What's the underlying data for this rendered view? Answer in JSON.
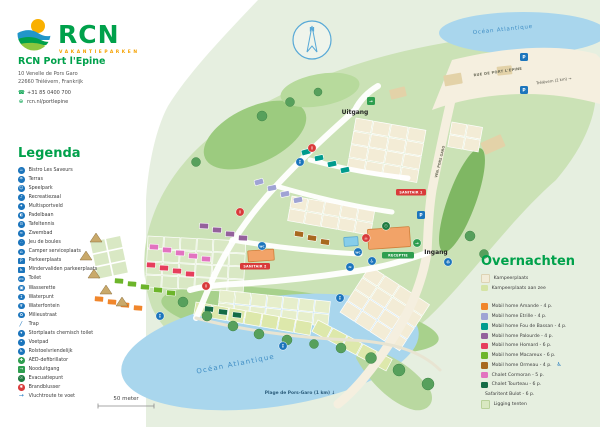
{
  "brand": {
    "logo_text": "RCN",
    "tagline": "VAKANTIEPARKEN"
  },
  "park": {
    "name": "RCN Port l'Epine",
    "address_line1": "10 Venelle de Pors Garo",
    "address_line2": "22660 Trélévern, Frankrijk",
    "phone": "+31 85 0400 700",
    "website": "rcn.nl/portlepine"
  },
  "legend": {
    "heading": "Legenda",
    "default_icon_bg": "#1c75bc",
    "items": [
      {
        "icon": "restaurant-icon",
        "glyph": "☕",
        "label": "Bistro Les Saveurs"
      },
      {
        "icon": "terrace-icon",
        "glyph": "☂",
        "label": "Terras"
      },
      {
        "icon": "playground-icon",
        "glyph": "☺",
        "label": "Speelpark"
      },
      {
        "icon": "recreation-hall-icon",
        "glyph": "♪",
        "label": "Recreatiezaal"
      },
      {
        "icon": "multisport-icon",
        "glyph": "✦",
        "label": "Multisportveld"
      },
      {
        "icon": "padel-icon",
        "glyph": "◐",
        "label": "Padelbaan"
      },
      {
        "icon": "table-tennis-icon",
        "glyph": "⊙",
        "label": "Tafeltennis"
      },
      {
        "icon": "pool-icon",
        "glyph": "≈",
        "label": "Zwembad"
      },
      {
        "icon": "petanque-icon",
        "glyph": "∴",
        "label": "Jeu de boules"
      },
      {
        "icon": "camper-service-icon",
        "glyph": "⌂",
        "label": "Camper serviceplaats"
      },
      {
        "icon": "parking-icon",
        "glyph": "P",
        "shape": "square",
        "label": "Parkeerplaats"
      },
      {
        "icon": "disabled-parking-icon",
        "glyph": "♿",
        "shape": "square",
        "label": "Mindervaliden parkeerplaats"
      },
      {
        "icon": "toilet-icon",
        "glyph": "WC",
        "label": "Toilet"
      },
      {
        "icon": "laundry-icon",
        "glyph": "▣",
        "label": "Wasserette"
      },
      {
        "icon": "water-tap-icon",
        "glyph": "↧",
        "label": "Waterpunt"
      },
      {
        "icon": "fountain-icon",
        "glyph": "♆",
        "label": "Waterfontein"
      },
      {
        "icon": "recycling-icon",
        "glyph": "♻",
        "label": "Milieustraat"
      },
      {
        "icon": "stairs-icon",
        "glyph": "╱",
        "shape": "bare",
        "label": "Trap"
      },
      {
        "icon": "chemical-toilet-icon",
        "glyph": "▾",
        "label": "Stortplaats chemisch toilet"
      },
      {
        "icon": "footpath-icon",
        "glyph": "•",
        "label": "Voetpad"
      },
      {
        "icon": "wheelchair-icon",
        "glyph": "♿",
        "label": "Rolstoelvriendelijk"
      },
      {
        "icon": "aed-icon",
        "glyph": "✚",
        "bg": "#2e9e4f",
        "label": "AED-defibrillator"
      },
      {
        "icon": "emergency-exit-icon",
        "glyph": "→",
        "shape": "square",
        "bg": "#2e9e4f",
        "label": "Nooduitgang"
      },
      {
        "icon": "evacuation-icon",
        "glyph": "☉",
        "bg": "#1d7a3f",
        "label": "Evacuatiepunt"
      },
      {
        "icon": "fire-extinguisher-icon",
        "glyph": "✱",
        "bg": "#d93a3a",
        "label": "Brandblusser"
      },
      {
        "icon": "escape-route-icon",
        "glyph": "→",
        "shape": "bare",
        "label": "Vluchtroute te voet"
      }
    ]
  },
  "accommodations": {
    "heading": "Overnachten",
    "colors": {
      "kampeerplaats": "#f2ecd8",
      "aanzee": "#d5e4a5",
      "amande": "#f0862c",
      "etrille": "#9fa3d4",
      "fou": "#009b8d",
      "palourde": "#94619c",
      "homard": "#e63e5c",
      "macareux": "#6db52b",
      "ormeau": "#a8681f",
      "cormoran": "#e273c0",
      "tourteau": "#156b46",
      "bulot": "#c9a96a",
      "ligging": "#d9e8c2"
    },
    "items": [
      {
        "label": "Kampeerplaats",
        "key": "kampeerplaats",
        "border": "#ddd3b4"
      },
      {
        "label": "Kampeerplaats aan zee",
        "key": "aanzee",
        "gap": true
      },
      {
        "label": "Mobil home Amande - 4 p.",
        "key": "amande"
      },
      {
        "label": "Mobil home Etrille - 4 p.",
        "key": "etrille"
      },
      {
        "label": "Mobil home Fou de Bassan - 4 p.",
        "key": "fou"
      },
      {
        "label": "Mobil home Palourde - 4 p.",
        "key": "palourde"
      },
      {
        "label": "Mobil home Homard - 6 p.",
        "key": "homard"
      },
      {
        "label": "Mobil home Macareux - 6 p.",
        "key": "macareux"
      },
      {
        "label": "Mobil home Ormeau - 4 p.",
        "key": "ormeau",
        "wheelchair": true
      },
      {
        "label": "Chalet Cormoran - 5 p.",
        "key": "cormoran"
      },
      {
        "label": "Chalet Tourteau - 6 p.",
        "key": "tourteau"
      },
      {
        "label": "Safaritent Bulot - 6 p.",
        "key": "bulot",
        "tent": true
      },
      {
        "label": "Ligging tenten",
        "key": "ligging",
        "border": "#b9d19a"
      }
    ]
  },
  "map": {
    "compass_n": "N",
    "labels": [
      {
        "id": "ocean-top",
        "text": "Océan Atlantique",
        "x": 503,
        "y": 31,
        "size": 5.5,
        "fill": "#3f8dc4",
        "rot": -6,
        "ls": 0.8
      },
      {
        "id": "ocean-bottom",
        "text": "Océan Atlantique",
        "x": 236,
        "y": 366,
        "size": 7,
        "fill": "#3f8dc4",
        "rot": -11,
        "ls": 1.2
      },
      {
        "id": "road-rue",
        "text": "RUE DE PORT L'ÉPINE",
        "x": 498,
        "y": 73,
        "size": 3.6,
        "fill": "#6a6a58",
        "rot": -8,
        "ls": 0.3,
        "bold": true
      },
      {
        "id": "road-trelevern",
        "text": "Trélévern (2 km) →",
        "x": 554,
        "y": 82,
        "size": 3.8,
        "fill": "#55544a",
        "rot": -8
      },
      {
        "id": "road-ven",
        "text": "VEN. PORS GARO",
        "x": 441,
        "y": 162,
        "size": 3.4,
        "fill": "#6a6a58",
        "rot": -76,
        "bold": true
      },
      {
        "id": "exit-label",
        "text": "Uitgang",
        "x": 355,
        "y": 114,
        "size": 6,
        "fill": "#222",
        "bold": true
      },
      {
        "id": "entrance-label",
        "text": "Ingang",
        "x": 436,
        "y": 254,
        "size": 6,
        "fill": "#222",
        "bold": true
      },
      {
        "id": "beach-label",
        "text": "Plage de Pors-Garo (1 km) ↓",
        "x": 300,
        "y": 394,
        "size": 4.4,
        "fill": "#2c5d7c",
        "bold": true
      },
      {
        "id": "scale-label",
        "text": "50 meter",
        "x": 126,
        "y": 400,
        "size": 5.5,
        "fill": "#444"
      }
    ],
    "badges": [
      {
        "text": "RECEPTIE",
        "x": 382,
        "y": 252,
        "w": 32,
        "bg": "#2e9e4f"
      },
      {
        "text": "SANITAIR 1",
        "x": 396,
        "y": 189,
        "w": 30,
        "bg": "#d93a3a"
      },
      {
        "text": "SANITAIR 2",
        "x": 240,
        "y": 263,
        "w": 30,
        "bg": "#d93a3a"
      }
    ],
    "icons": [
      {
        "name": "parking-icon",
        "x": 524,
        "y": 57,
        "shape": "square",
        "bg": "#1c75bc",
        "glyph": "P"
      },
      {
        "name": "parking-icon",
        "x": 524,
        "y": 90,
        "shape": "square",
        "bg": "#1c75bc",
        "glyph": "P"
      },
      {
        "name": "parking-icon",
        "x": 421,
        "y": 215,
        "shape": "square",
        "bg": "#1c75bc",
        "glyph": "P"
      },
      {
        "name": "exit-icon",
        "x": 371,
        "y": 101,
        "shape": "square",
        "bg": "#2e9e4f",
        "glyph": "→"
      },
      {
        "name": "entrance-icon",
        "x": 417,
        "y": 243,
        "shape": "circle",
        "bg": "#2e9e4f",
        "glyph": "→"
      },
      {
        "name": "info-icon",
        "x": 312,
        "y": 148,
        "shape": "circle",
        "bg": "#d93a3a",
        "glyph": "i"
      },
      {
        "name": "info-icon",
        "x": 240,
        "y": 212,
        "shape": "circle",
        "bg": "#d93a3a",
        "glyph": "i"
      },
      {
        "name": "info-icon",
        "x": 206,
        "y": 286,
        "shape": "circle",
        "bg": "#d93a3a",
        "glyph": "i"
      },
      {
        "name": "restaurant-icon",
        "x": 366,
        "y": 238,
        "shape": "circle",
        "bg": "#d93a3a",
        "glyph": "☕"
      },
      {
        "name": "toilet-icon",
        "x": 358,
        "y": 252,
        "shape": "circle",
        "bg": "#1c75bc",
        "glyph": "WC"
      },
      {
        "name": "wheelchair-icon",
        "x": 372,
        "y": 261,
        "shape": "circle",
        "bg": "#1c75bc",
        "glyph": "♿"
      },
      {
        "name": "pool-icon",
        "x": 350,
        "y": 267,
        "shape": "circle",
        "bg": "#1c75bc",
        "glyph": "≈"
      },
      {
        "name": "evacuation-icon",
        "x": 386,
        "y": 226,
        "shape": "circle",
        "bg": "#1d7a3f",
        "glyph": "☉"
      },
      {
        "name": "water-tap-icon",
        "x": 300,
        "y": 162,
        "shape": "circle",
        "bg": "#1c75bc",
        "glyph": "↧"
      },
      {
        "name": "water-tap-icon",
        "x": 340,
        "y": 298,
        "shape": "circle",
        "bg": "#1c75bc",
        "glyph": "↧"
      },
      {
        "name": "toilet-icon",
        "x": 262,
        "y": 246,
        "shape": "circle",
        "bg": "#1c75bc",
        "glyph": "WC"
      },
      {
        "name": "water-tap-icon",
        "x": 160,
        "y": 316,
        "shape": "circle",
        "bg": "#1c75bc",
        "glyph": "↧"
      },
      {
        "name": "water-tap-icon",
        "x": 283,
        "y": 346,
        "shape": "circle",
        "bg": "#1c75bc",
        "glyph": "↧"
      },
      {
        "name": "recycling-icon",
        "x": 448,
        "y": 262,
        "shape": "circle",
        "bg": "#1c75bc",
        "glyph": "♻"
      }
    ],
    "clusters": [
      {
        "x": 356,
        "y": 118,
        "rows": 4,
        "cols": 4,
        "cw": 17,
        "ch": 12.5,
        "angle": 10,
        "fill": "#f3ecd6"
      },
      {
        "x": 452,
        "y": 122,
        "rows": 2,
        "cols": 2,
        "cw": 15,
        "ch": 12,
        "angle": 10,
        "fill": "#f3ecd6"
      },
      {
        "x": 292,
        "y": 196,
        "rows": 2,
        "cols": 5,
        "cw": 16,
        "ch": 12,
        "angle": 10,
        "fill": "#f3ecd6"
      },
      {
        "x": 370,
        "y": 266,
        "rows": 4,
        "cols": 4,
        "cw": 17,
        "ch": 13,
        "angle": 33,
        "fill": "#f3ecd6"
      },
      {
        "x": 148,
        "y": 236,
        "rows": 4,
        "cols": 6,
        "cw": 15.5,
        "ch": 12,
        "angle": 3,
        "fill": "#d9e8c4"
      },
      {
        "x": 220,
        "y": 290,
        "rows": 2,
        "cols": 7,
        "cw": 15,
        "ch": 12,
        "angle": 6,
        "fill": "#e6eecb"
      },
      {
        "x": 196,
        "y": 302,
        "rows": 1,
        "cols": 7,
        "cw": 16,
        "ch": 13,
        "angle": 10,
        "fill": "#dde8ab"
      },
      {
        "x": 318,
        "y": 320,
        "rows": 1,
        "cols": 5,
        "cw": 16,
        "ch": 13,
        "angle": 28,
        "fill": "#dde8ab"
      },
      {
        "x": 90,
        "y": 242,
        "rows": 3,
        "cols": 2,
        "cw": 15,
        "ch": 12,
        "angle": -12,
        "fill": "#d9e8c4"
      }
    ],
    "homes": [
      {
        "x": 306,
        "y": 152,
        "a": -15,
        "key": "fou"
      },
      {
        "x": 319,
        "y": 158,
        "a": -12,
        "key": "fou"
      },
      {
        "x": 332,
        "y": 164,
        "a": -12,
        "key": "fou"
      },
      {
        "x": 345,
        "y": 170,
        "a": -12,
        "key": "fou"
      },
      {
        "x": 259,
        "y": 182,
        "a": -15,
        "key": "etrille"
      },
      {
        "x": 272,
        "y": 188,
        "a": -12,
        "key": "etrille"
      },
      {
        "x": 285,
        "y": 194,
        "a": -12,
        "key": "etrille"
      },
      {
        "x": 298,
        "y": 200,
        "a": -12,
        "key": "etrille"
      },
      {
        "x": 204,
        "y": 226,
        "a": 3,
        "key": "palourde"
      },
      {
        "x": 217,
        "y": 230,
        "a": 3,
        "key": "palourde"
      },
      {
        "x": 230,
        "y": 234,
        "a": 3,
        "key": "palourde"
      },
      {
        "x": 243,
        "y": 238,
        "a": 3,
        "key": "palourde"
      },
      {
        "x": 154,
        "y": 247,
        "a": 3,
        "key": "cormoran"
      },
      {
        "x": 167,
        "y": 250,
        "a": 3,
        "key": "cormoran"
      },
      {
        "x": 180,
        "y": 253,
        "a": 3,
        "key": "cormoran"
      },
      {
        "x": 193,
        "y": 256,
        "a": 3,
        "key": "cormoran"
      },
      {
        "x": 206,
        "y": 259,
        "a": 3,
        "key": "cormoran"
      },
      {
        "x": 151,
        "y": 265,
        "a": 3,
        "key": "homard"
      },
      {
        "x": 164,
        "y": 268,
        "a": 3,
        "key": "homard"
      },
      {
        "x": 177,
        "y": 271,
        "a": 3,
        "key": "homard"
      },
      {
        "x": 190,
        "y": 274,
        "a": 3,
        "key": "homard"
      },
      {
        "x": 119,
        "y": 281,
        "a": 4,
        "key": "macareux"
      },
      {
        "x": 132,
        "y": 284,
        "a": 4,
        "key": "macareux"
      },
      {
        "x": 145,
        "y": 287,
        "a": 4,
        "key": "macareux"
      },
      {
        "x": 158,
        "y": 290,
        "a": 4,
        "key": "macareux"
      },
      {
        "x": 171,
        "y": 293,
        "a": 4,
        "key": "macareux"
      },
      {
        "x": 99,
        "y": 299,
        "a": 4,
        "key": "amande"
      },
      {
        "x": 112,
        "y": 302,
        "a": 4,
        "key": "amande"
      },
      {
        "x": 125,
        "y": 305,
        "a": 4,
        "key": "amande"
      },
      {
        "x": 138,
        "y": 308,
        "a": 4,
        "key": "amande"
      },
      {
        "x": 299,
        "y": 234,
        "a": 8,
        "key": "ormeau"
      },
      {
        "x": 312,
        "y": 238,
        "a": 8,
        "key": "ormeau"
      },
      {
        "x": 325,
        "y": 242,
        "a": 8,
        "key": "ormeau"
      },
      {
        "x": 209,
        "y": 309,
        "a": 6,
        "key": "tourteau"
      },
      {
        "x": 223,
        "y": 312,
        "a": 6,
        "key": "tourteau"
      },
      {
        "x": 237,
        "y": 315,
        "a": 6,
        "key": "tourteau"
      }
    ],
    "tents": [
      {
        "x": 96,
        "y": 238
      },
      {
        "x": 86,
        "y": 256
      },
      {
        "x": 94,
        "y": 274
      },
      {
        "x": 106,
        "y": 290
      },
      {
        "x": 122,
        "y": 302
      }
    ],
    "trees": [
      {
        "x": 183,
        "y": 302,
        "r": 5
      },
      {
        "x": 207,
        "y": 316,
        "r": 5
      },
      {
        "x": 233,
        "y": 326,
        "r": 5
      },
      {
        "x": 259,
        "y": 334,
        "r": 5
      },
      {
        "x": 287,
        "y": 340,
        "r": 5
      },
      {
        "x": 314,
        "y": 344,
        "r": 4.5
      },
      {
        "x": 341,
        "y": 348,
        "r": 5
      },
      {
        "x": 371,
        "y": 358,
        "r": 5.5
      },
      {
        "x": 399,
        "y": 370,
        "r": 6
      },
      {
        "x": 428,
        "y": 384,
        "r": 6
      },
      {
        "x": 262,
        "y": 116,
        "r": 5
      },
      {
        "x": 290,
        "y": 102,
        "r": 4.5
      },
      {
        "x": 318,
        "y": 92,
        "r": 4
      },
      {
        "x": 470,
        "y": 236,
        "r": 5
      },
      {
        "x": 484,
        "y": 254,
        "r": 4.5
      },
      {
        "x": 196,
        "y": 162,
        "r": 4.5
      }
    ],
    "buildings": [
      {
        "x": 390,
        "y": 88,
        "w": 16,
        "h": 10,
        "a": -14,
        "fill": "#e3d2a8"
      },
      {
        "x": 444,
        "y": 74,
        "w": 18,
        "h": 11,
        "a": -10,
        "fill": "#e3d2a8"
      },
      {
        "x": 497,
        "y": 66,
        "w": 15,
        "h": 9,
        "a": -6,
        "fill": "#e3d2a8"
      },
      {
        "x": 482,
        "y": 138,
        "w": 22,
        "h": 13,
        "a": -24,
        "fill": "#e3d2a8"
      },
      {
        "x": 368,
        "y": 228,
        "w": 42,
        "h": 20,
        "a": -4,
        "fill": "#f2a368",
        "stroke": "#cf7f3a"
      },
      {
        "x": 248,
        "y": 250,
        "w": 26,
        "h": 11,
        "a": -4,
        "fill": "#f2a368",
        "stroke": "#cf7f3a"
      },
      {
        "x": 344,
        "y": 237,
        "w": 14,
        "h": 9,
        "a": -4,
        "fill": "#86cdea",
        "stroke": "#5aa9cf"
      }
    ]
  }
}
